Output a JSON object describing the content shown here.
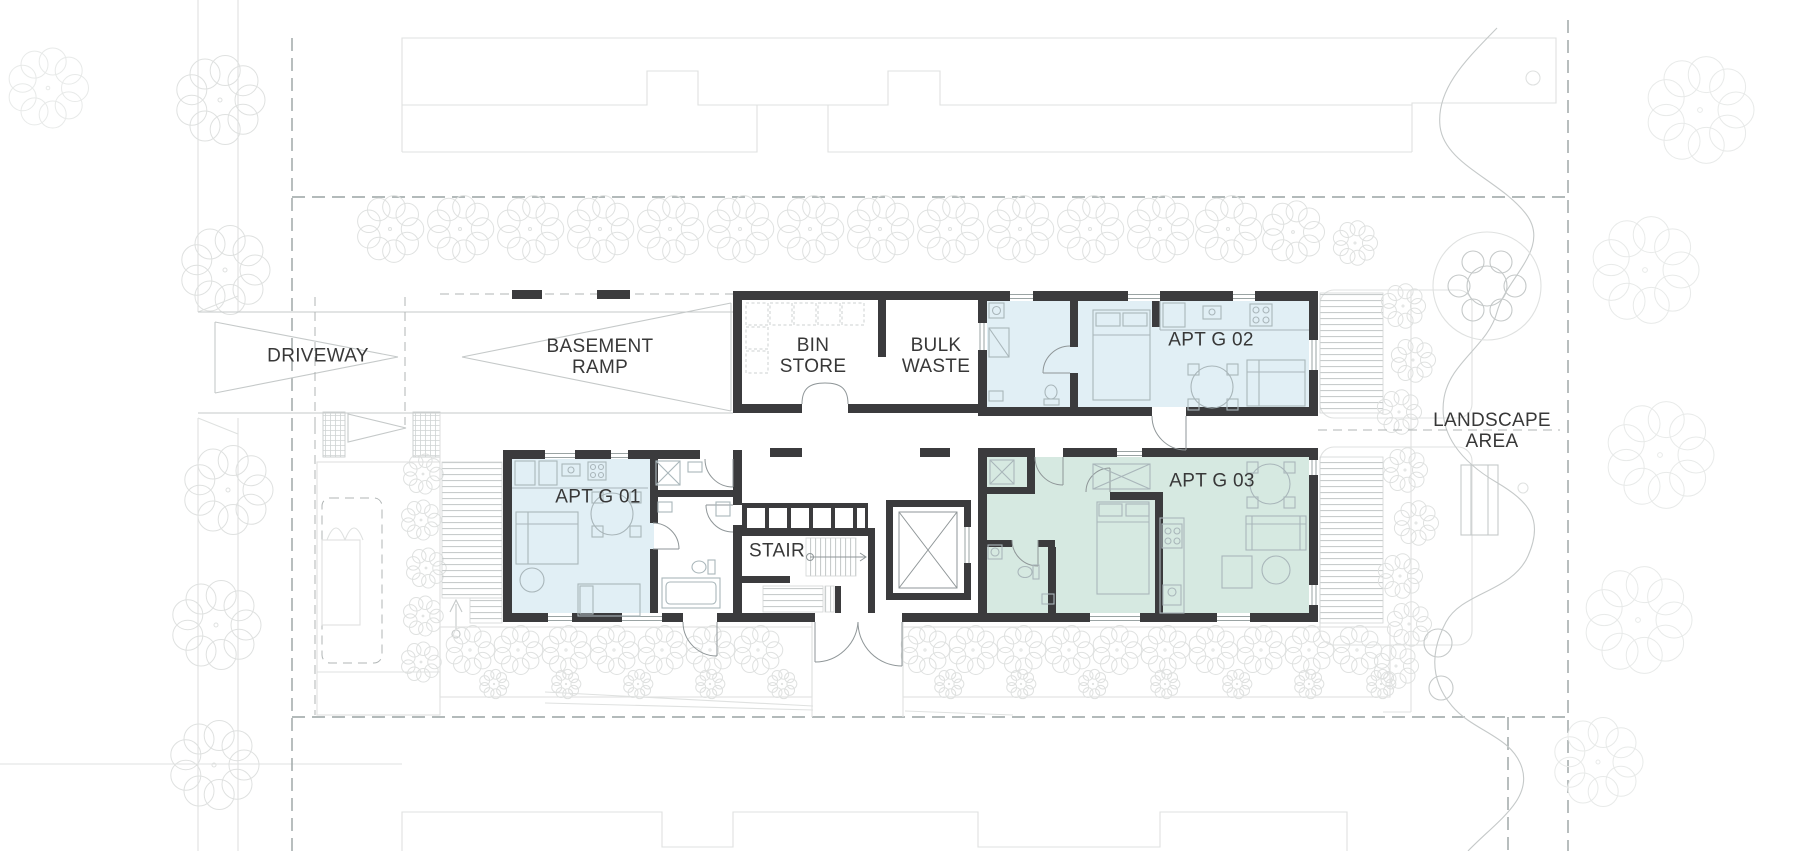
{
  "plan_labels": {
    "driveway": "DRIVEWAY",
    "basement_ramp": [
      "BASEMENT",
      "RAMP"
    ],
    "bin_store": [
      "BIN",
      "STORE"
    ],
    "bulk_waste": [
      "BULK",
      "WASTE"
    ],
    "apt_g01": "APT G 01",
    "apt_g02": "APT G 02",
    "apt_g03": "APT G 03",
    "stair": "STAIR",
    "landscape_area": [
      "LANDSCAPE",
      "AREA"
    ]
  },
  "colors": {
    "wall": "#3b3b3d",
    "apartment-blue": "#e1eff5",
    "apartment-green": "#d6e9e1",
    "line": "#c5c9c9",
    "line-faint": "#dfe1e0",
    "boundary": "#9aa3a3",
    "furniture": "#a9b6ba",
    "door": "#8f9698",
    "deck-line": "#c2c6c6",
    "text": "#383838"
  }
}
